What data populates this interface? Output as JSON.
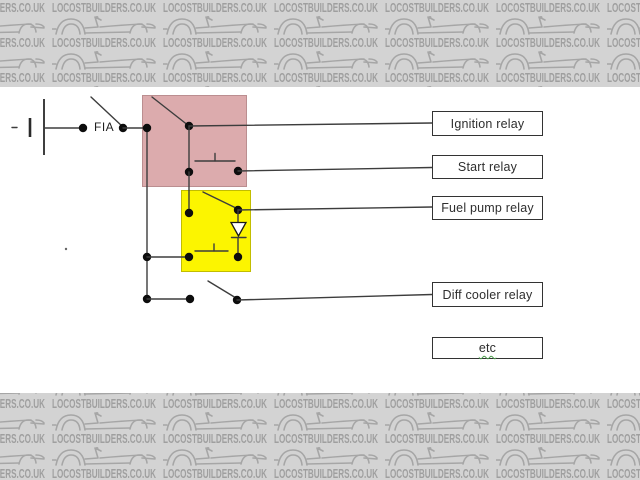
{
  "watermark": {
    "text": "LOCOSTBUILDERS.CO.UK",
    "band_background": "#d3d3d3",
    "text_color": "#9f9f9f",
    "car_icon": "kit-car-sketch-icon"
  },
  "diagram": {
    "kill_switch_label": "FIA",
    "relay_boxes": [
      {
        "label": "Ignition relay"
      },
      {
        "label": "Start relay"
      },
      {
        "label": "Fuel pump relay"
      },
      {
        "label": "Diff cooler relay"
      },
      {
        "label": "etc",
        "grammar_underline": true
      }
    ],
    "highlights": {
      "ignition_start_relay_block": "#dcabad",
      "fuel_pump_relay_block": "#fcf500"
    }
  }
}
